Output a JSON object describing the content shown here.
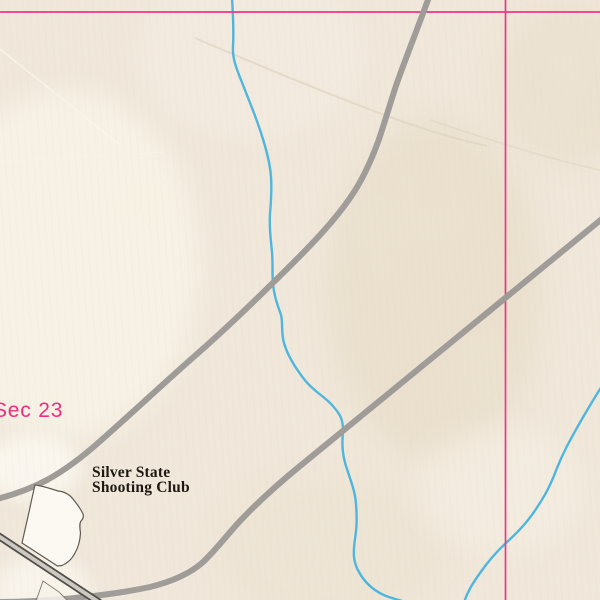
{
  "map": {
    "kind": "topographic-map-view",
    "labels": {
      "section_label": "Sec 23",
      "poi_line1": "Silver State",
      "poi_line2": "Shooting Club"
    },
    "features": {
      "section_lines": "pink township/section grid: one horizontal line near top, one vertical line right of center",
      "roads": "two gray unimproved roads crossing diagonally; divided highway in southwest corner",
      "streams": "two intermittent blue streams flowing toward the south edge",
      "structures": "outlined grounds of the Silver State Shooting Club near the southwest"
    },
    "colors": {
      "background": "#f1e9dc",
      "section_line": "#ee2d82",
      "section_label_text": "#ee2d82",
      "road_gray": "#9b9896",
      "highway_casing": "#474440",
      "highway_fill": "#cbc8c2",
      "stream_blue": "#46b4e0",
      "building_fill": "#fdfbf6",
      "building_outline": "#56524b",
      "trail_tan": "#ded2bf",
      "poi_text": "#201913"
    }
  }
}
